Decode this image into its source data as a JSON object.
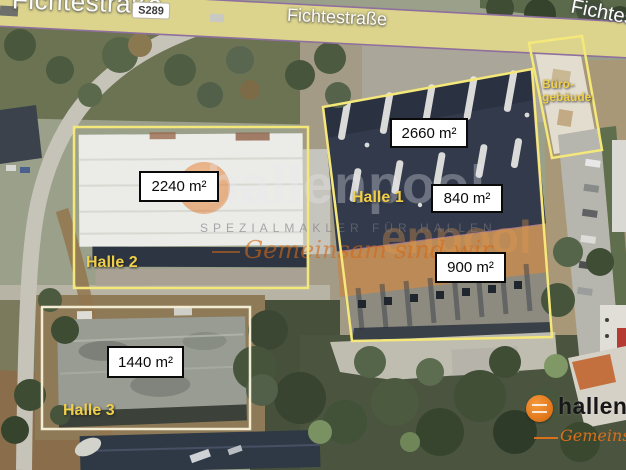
{
  "road": {
    "label_left": "Fichtestraße",
    "badge": "S289",
    "label_center": "Fichtestraße",
    "label_right": "Fichtestraße"
  },
  "halls": {
    "halle1": {
      "label": "Halle 1",
      "area_top": "2660 m²",
      "area_middle": "840 m²",
      "area_bottom": "900 m²"
    },
    "halle2": {
      "label": "Halle 2",
      "area": "2240 m²"
    },
    "halle3": {
      "label": "Halle 3",
      "area": "1440 m²"
    },
    "buero": {
      "label_line1": "Büro-",
      "label_line2": "gebäude"
    }
  },
  "watermark": {
    "brand": "hallenpool",
    "brand_fragment": "enpool",
    "caption": "SPEZIALMAKLER FÜR HALLEN",
    "slogan": "Gemeinsam sind wir"
  },
  "logo": {
    "brand": "hallenpool",
    "slogan": "Gemeinsam sind wir"
  },
  "colors": {
    "outline_yellow": "#f5e87a",
    "outline_pale": "#f2ecd2",
    "hall_label_yellow": "#f0cf4a",
    "brand_orange": "#e8791e",
    "road_fill": "#dcd48c",
    "road_edge": "#8f6f9e"
  }
}
